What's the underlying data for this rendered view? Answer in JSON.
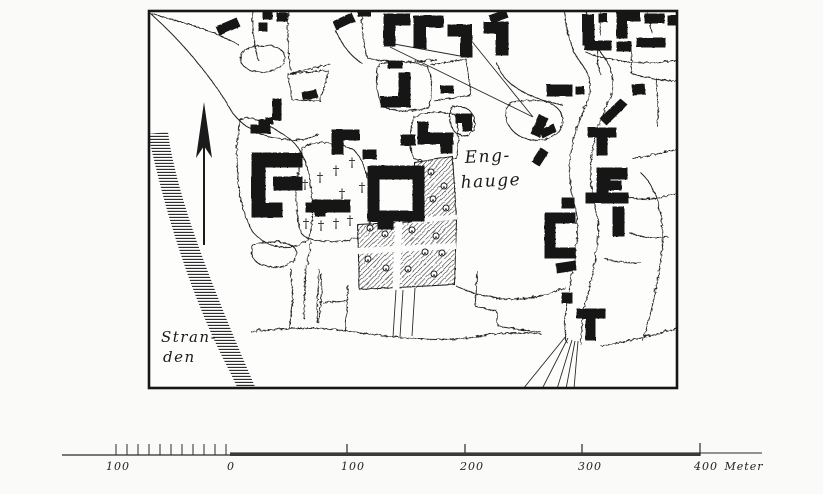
{
  "map": {
    "title": "historic-town-plan",
    "labels": {
      "enghauge": [
        "Eng-",
        "hauge"
      ],
      "stranden": [
        "Stran-",
        "den"
      ]
    },
    "symbols": {
      "cross_glyph": "†",
      "north_arrow": "north-arrow",
      "shoreline": "hatched-shore-band",
      "garden": "hatched-garden-with-trees"
    },
    "colors": {
      "ink": "#1b1b1b",
      "paper": "#fdfdfb"
    }
  },
  "scale_bar": {
    "left_label": "100",
    "origin_label": "0",
    "right_labels": [
      "100",
      "200",
      "300",
      "400"
    ],
    "unit": "Meter"
  }
}
